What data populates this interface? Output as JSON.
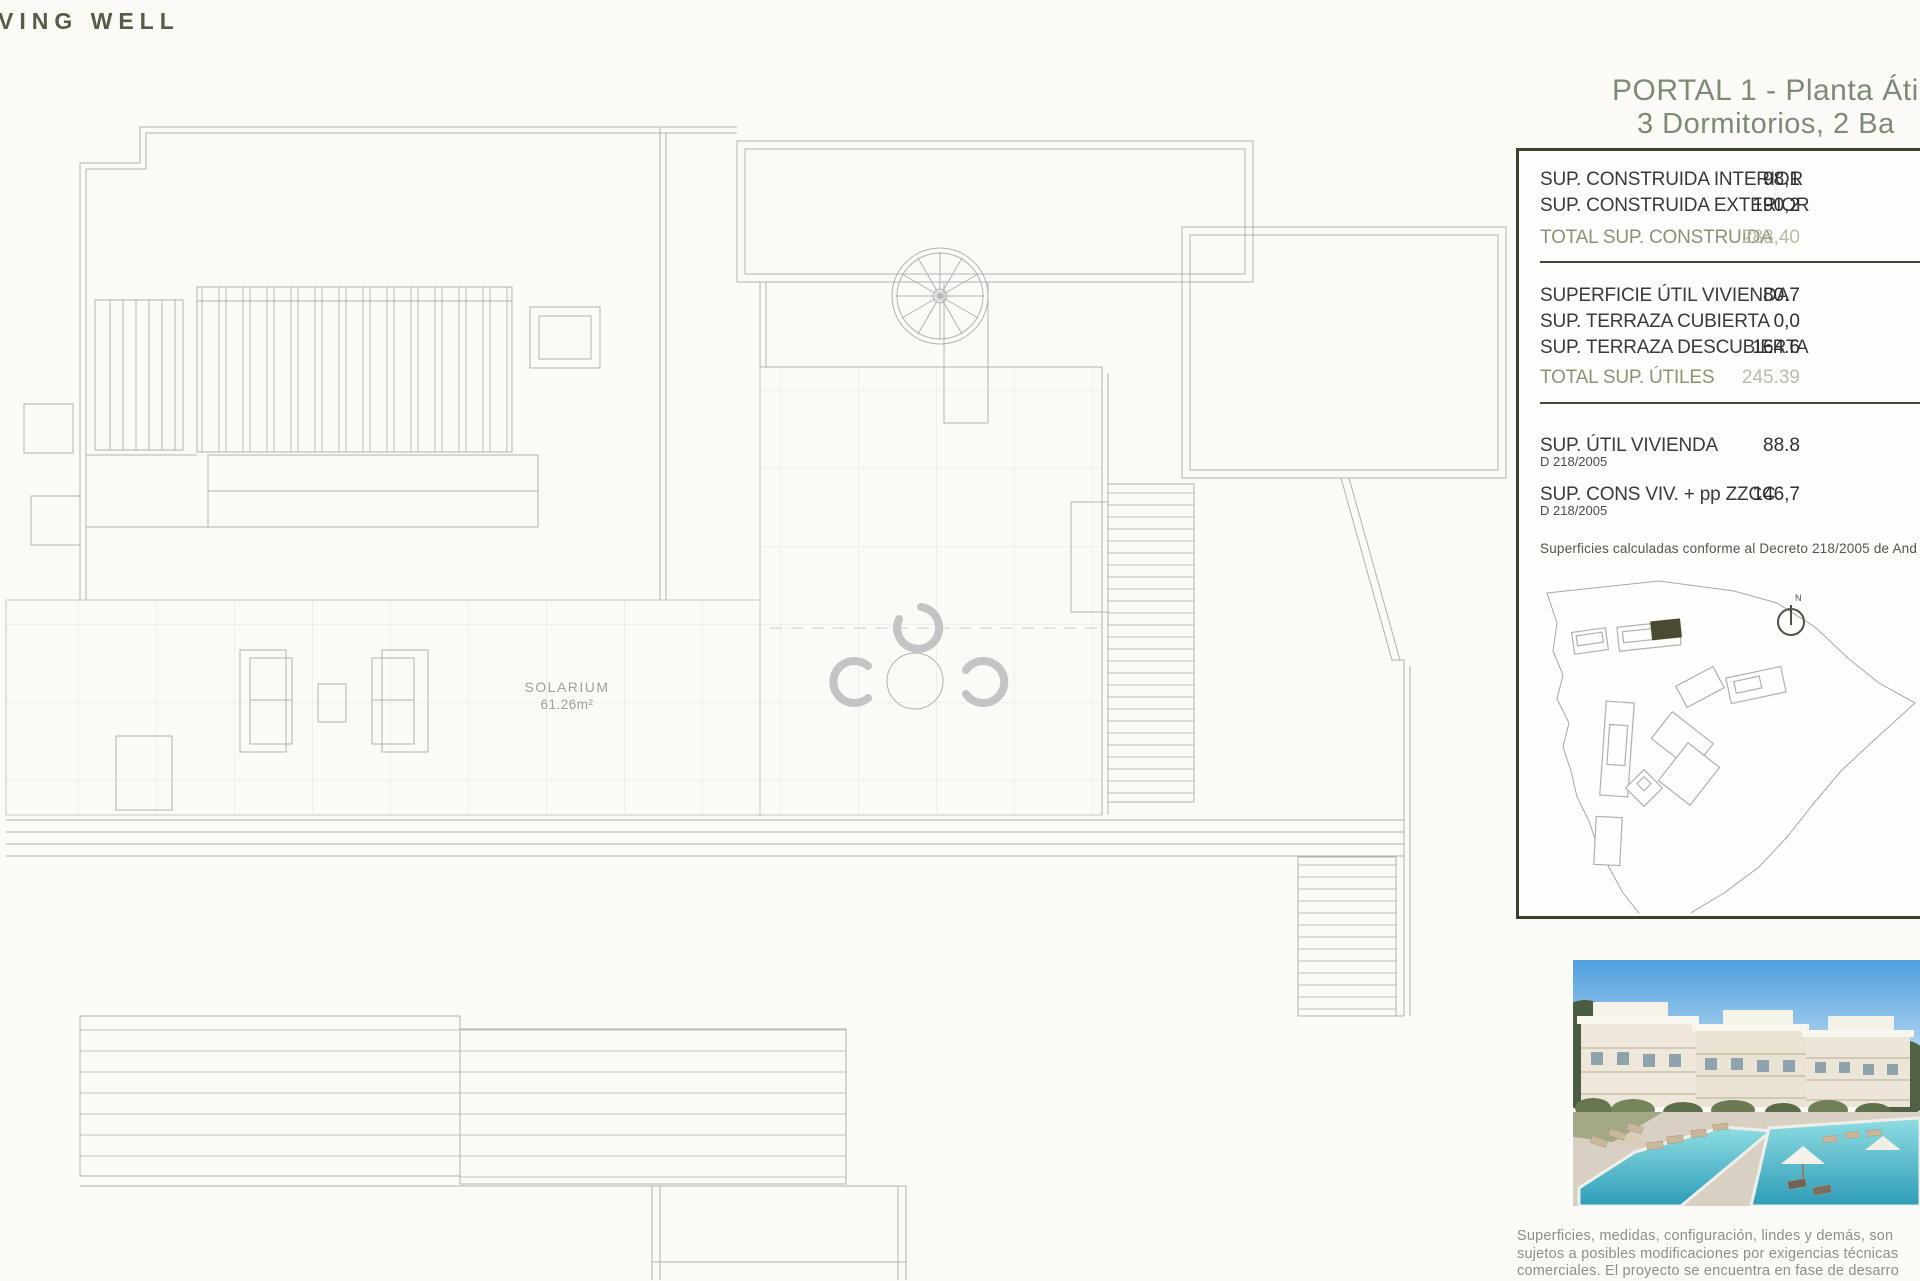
{
  "brand": {
    "logo_text": "VING WELL"
  },
  "header": {
    "title_line1": "PORTAL 1 - Planta Áti",
    "title_line2": "3 Dormitorios, 2 Ba"
  },
  "plan": {
    "solarium_label": "SOLARIUM",
    "solarium_area": "61.26m²"
  },
  "panel": {
    "construida": {
      "rows": [
        {
          "label": "SUP. CONSTRUIDA INTERIOR",
          "value": "98,1"
        },
        {
          "label": "SUP. CONSTRUIDA EXTERIOR",
          "value": "190,2"
        }
      ],
      "total": {
        "label": "TOTAL SUP. CONSTRUIDA",
        "value": "288,40"
      }
    },
    "utiles": {
      "rows": [
        {
          "label": "SUPERFICIE ÚTIL VIVIENDA",
          "value": "80.7"
        },
        {
          "label": "SUP. TERRAZA CUBIERTA",
          "value": "0,0"
        },
        {
          "label": "SUP. TERRAZA DESCUBIERTA",
          "value": "164.6"
        }
      ],
      "total": {
        "label": "TOTAL SUP. ÚTILES",
        "value": "245.39"
      }
    },
    "decreto": {
      "rows": [
        {
          "label": "SUP. ÚTIL VIVIENDA",
          "sub": "D 218/2005",
          "value": "88.8"
        },
        {
          "label": "SUP. CONS VIV. + pp ZZCC",
          "sub": "D 218/2005",
          "value": "146,7"
        }
      ]
    },
    "note": "Superficies calculadas conforme al Decreto 218/2005 de And",
    "compass_label": "N"
  },
  "disclaimer": {
    "line1": "Superficies, medidas, configuración, lindes y demás, son",
    "line2": "sujetos a posibles modificaciones por exigencias técnicas",
    "line3": "comerciales. El proyecto se encuentra en fase de desarro"
  },
  "colors": {
    "panel_border_olive": "#3e3e2b",
    "title_green": "#7d8a78",
    "highlight_building": "#4a4a30",
    "plan_line_gray": "#b1b1b1",
    "pool_turquoise": "#35a8bf",
    "sky_blue": "#4f9fdd"
  }
}
